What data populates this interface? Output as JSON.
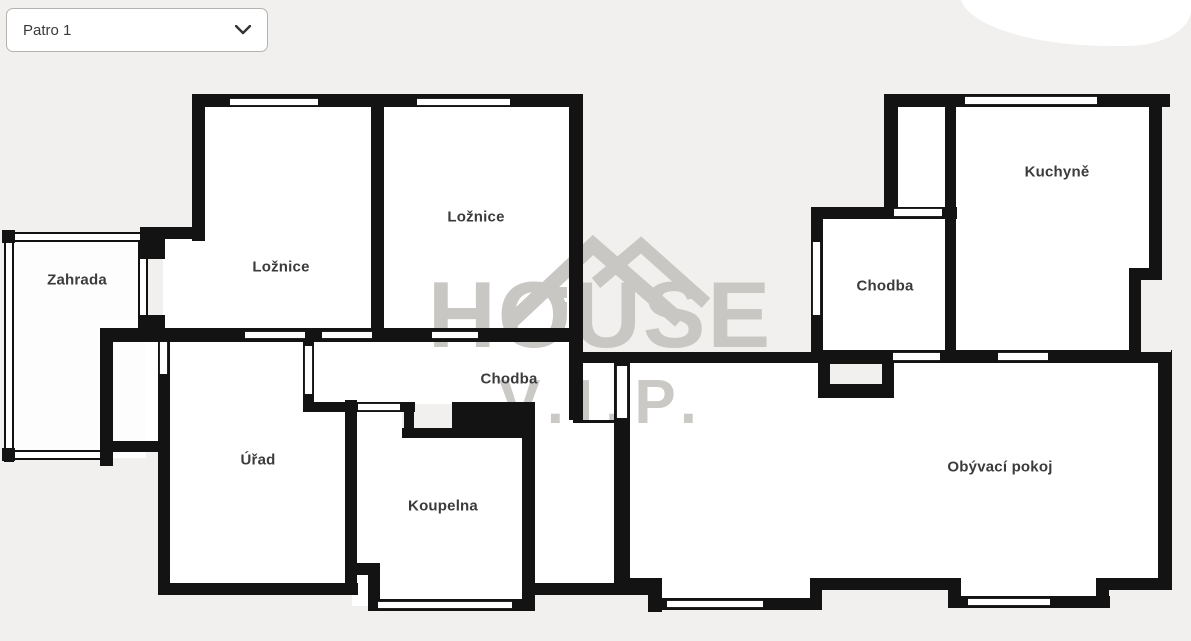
{
  "dropdown": {
    "label": "Patro 1",
    "chevron_icon": "chevron-down-icon"
  },
  "watermark": {
    "brand": "HOUSE",
    "sub": "V.I.P.",
    "color": "#c9c7c4",
    "icon": "house-roof-icon"
  },
  "colors": {
    "background": "#f2f0ee",
    "room_fill": "#ffffff",
    "wall": "#131313",
    "label_text": "#3b3b3b",
    "dropdown_border": "#b5b3b0"
  },
  "rooms": [
    {
      "id": "zahrada",
      "label": "Zahrada",
      "cx": 77,
      "cy": 280
    },
    {
      "id": "loznice-left",
      "label": "Ložnice",
      "cx": 281,
      "cy": 267
    },
    {
      "id": "loznice-top",
      "label": "Ložnice",
      "cx": 476,
      "cy": 217
    },
    {
      "id": "chodba-center",
      "label": "Chodba",
      "cx": 509,
      "cy": 379
    },
    {
      "id": "urad",
      "label": "Úřad",
      "cx": 258,
      "cy": 460
    },
    {
      "id": "koupelna",
      "label": "Koupelna",
      "cx": 443,
      "cy": 506
    },
    {
      "id": "chodba-right",
      "label": "Chodba",
      "cx": 885,
      "cy": 286
    },
    {
      "id": "kuchyne",
      "label": "Kuchyně",
      "cx": 1057,
      "cy": 172
    },
    {
      "id": "obyvaci-pokoj",
      "label": "Obývací pokoj",
      "cx": 1000,
      "cy": 467
    }
  ],
  "plan": {
    "floors": [
      {
        "name": "bedroom-left-floor",
        "x": 202,
        "y": 106,
        "w": 176,
        "h": 228
      },
      {
        "name": "bedroom-left-floor-ext",
        "x": 163,
        "y": 239,
        "w": 67,
        "h": 95
      },
      {
        "name": "bedroom-top-floor",
        "x": 380,
        "y": 106,
        "w": 196,
        "h": 230
      },
      {
        "name": "corridor-center-floor",
        "x": 308,
        "y": 340,
        "w": 266,
        "h": 64
      },
      {
        "name": "corridor-lower-floor",
        "x": 357,
        "y": 404,
        "w": 45,
        "h": 34
      },
      {
        "name": "passage-floor",
        "x": 535,
        "y": 360,
        "w": 84,
        "h": 226
      },
      {
        "name": "office-floor",
        "x": 166,
        "y": 336,
        "w": 186,
        "h": 252
      },
      {
        "name": "utility-floor",
        "x": 108,
        "y": 336,
        "w": 56,
        "h": 108
      },
      {
        "name": "bathroom-floor",
        "x": 352,
        "y": 434,
        "w": 176,
        "h": 172
      },
      {
        "name": "living-room-floor",
        "x": 624,
        "y": 357,
        "w": 546,
        "h": 221
      },
      {
        "name": "living-room-floor-tab1",
        "x": 655,
        "y": 578,
        "w": 165,
        "h": 26
      },
      {
        "name": "living-room-floor-tab2",
        "x": 952,
        "y": 578,
        "w": 156,
        "h": 22
      },
      {
        "name": "hall-right-floor",
        "x": 821,
        "y": 217,
        "w": 126,
        "h": 133
      },
      {
        "name": "strip-room-floor",
        "x": 896,
        "y": 106,
        "w": 51,
        "h": 105
      },
      {
        "name": "kitchen-floor",
        "x": 947,
        "y": 106,
        "w": 202,
        "h": 250
      },
      {
        "name": "garden-floor",
        "x": 8,
        "y": 236,
        "w": 138,
        "h": 222,
        "garden": true
      }
    ],
    "walls": [
      {
        "name": "bedrooms-top-wall",
        "x": 192,
        "y": 94,
        "w": 390,
        "h": 13
      },
      {
        "name": "bedroom-left-wall",
        "x": 192,
        "y": 94,
        "w": 13,
        "h": 147
      },
      {
        "name": "bedroom-step-wall",
        "x": 140,
        "y": 227,
        "w": 64,
        "h": 12
      },
      {
        "name": "bedroom-step-stub",
        "x": 140,
        "y": 227,
        "w": 25,
        "h": 32
      },
      {
        "name": "garden-corner-block",
        "x": 140,
        "y": 315,
        "w": 25,
        "h": 20
      },
      {
        "name": "bedrooms-divider-wall",
        "x": 371,
        "y": 100,
        "w": 13,
        "h": 240
      },
      {
        "name": "bedroom-top-right-wall",
        "x": 569,
        "y": 94,
        "w": 14,
        "h": 326
      },
      {
        "name": "bedrooms-bottom-wall",
        "x": 100,
        "y": 328,
        "w": 483,
        "h": 14
      },
      {
        "name": "building-left-wall",
        "x": 100,
        "y": 328,
        "w": 13,
        "h": 138
      },
      {
        "name": "office-left-wall",
        "x": 158,
        "y": 340,
        "w": 12,
        "h": 255
      },
      {
        "name": "utility-bottom-wall",
        "x": 100,
        "y": 441,
        "w": 70,
        "h": 11
      },
      {
        "name": "office-bottom-wall",
        "x": 158,
        "y": 583,
        "w": 200,
        "h": 12
      },
      {
        "name": "office-right-wall",
        "x": 345,
        "y": 400,
        "w": 12,
        "h": 195
      },
      {
        "name": "office-corridor-stub",
        "x": 303,
        "y": 340,
        "w": 11,
        "h": 72
      },
      {
        "name": "corridor-bottom-wall",
        "x": 303,
        "y": 402,
        "w": 112,
        "h": 10
      },
      {
        "name": "corridor-step-block",
        "x": 452,
        "y": 402,
        "w": 83,
        "h": 36
      },
      {
        "name": "corridor-notch-bottom",
        "x": 402,
        "y": 428,
        "w": 52,
        "h": 10
      },
      {
        "name": "corridor-notch-stub",
        "x": 404,
        "y": 402,
        "w": 10,
        "h": 36
      },
      {
        "name": "bathroom-step-h",
        "x": 345,
        "y": 563,
        "w": 35,
        "h": 12
      },
      {
        "name": "bathroom-step-v",
        "x": 368,
        "y": 563,
        "w": 12,
        "h": 48
      },
      {
        "name": "bathroom-bottom-wall",
        "x": 368,
        "y": 599,
        "w": 167,
        "h": 12
      },
      {
        "name": "bathroom-right-wall",
        "x": 522,
        "y": 420,
        "w": 13,
        "h": 191
      },
      {
        "name": "passage-bottom-wall",
        "x": 522,
        "y": 583,
        "w": 140,
        "h": 12
      },
      {
        "name": "living-left-wall",
        "x": 614,
        "y": 352,
        "w": 16,
        "h": 240
      },
      {
        "name": "passage-threshold",
        "x": 573,
        "y": 420,
        "w": 43,
        "h": 3
      },
      {
        "name": "corridor-ext-top-wall",
        "x": 569,
        "y": 352,
        "w": 246,
        "h": 11
      },
      {
        "name": "living-top-wall",
        "x": 815,
        "y": 350,
        "w": 355,
        "h": 13
      },
      {
        "name": "shaft-notch-wall",
        "x": 818,
        "y": 352,
        "w": 76,
        "h": 46
      },
      {
        "name": "hall-right-left-wall",
        "x": 811,
        "y": 207,
        "w": 12,
        "h": 151
      },
      {
        "name": "hall-right-top-wall",
        "x": 811,
        "y": 207,
        "w": 146,
        "h": 12
      },
      {
        "name": "kitchen-left-wall",
        "x": 884,
        "y": 94,
        "w": 14,
        "h": 119
      },
      {
        "name": "right-top-wall",
        "x": 884,
        "y": 94,
        "w": 286,
        "h": 13
      },
      {
        "name": "kitchen-divider-wall",
        "x": 945,
        "y": 100,
        "w": 11,
        "h": 256
      },
      {
        "name": "kitchen-right-wall-up",
        "x": 1149,
        "y": 94,
        "w": 13,
        "h": 186
      },
      {
        "name": "kitchen-step-wall",
        "x": 1129,
        "y": 268,
        "w": 33,
        "h": 12
      },
      {
        "name": "kitchen-right-wall-low",
        "x": 1129,
        "y": 268,
        "w": 12,
        "h": 92
      },
      {
        "name": "living-right-wall",
        "x": 1158,
        "y": 350,
        "w": 14,
        "h": 240
      },
      {
        "name": "living-bottom-up1",
        "x": 624,
        "y": 578,
        "w": 34,
        "h": 12
      },
      {
        "name": "living-bottom-step1",
        "x": 648,
        "y": 578,
        "w": 14,
        "h": 34
      },
      {
        "name": "living-bottom-low1",
        "x": 655,
        "y": 598,
        "w": 165,
        "h": 12
      },
      {
        "name": "living-bottom-step2",
        "x": 810,
        "y": 578,
        "w": 12,
        "h": 32
      },
      {
        "name": "living-bottom-up2",
        "x": 818,
        "y": 578,
        "w": 136,
        "h": 12
      },
      {
        "name": "living-bottom-step3",
        "x": 948,
        "y": 578,
        "w": 13,
        "h": 30
      },
      {
        "name": "living-bottom-low2",
        "x": 955,
        "y": 596,
        "w": 155,
        "h": 12
      },
      {
        "name": "living-bottom-step4",
        "x": 1096,
        "y": 578,
        "w": 13,
        "h": 30
      },
      {
        "name": "living-bottom-up3",
        "x": 1104,
        "y": 578,
        "w": 68,
        "h": 12
      },
      {
        "name": "garden-corner-tick-tl",
        "x": 2,
        "y": 230,
        "w": 13,
        "h": 13
      },
      {
        "name": "garden-corner-tick-bl",
        "x": 2,
        "y": 448,
        "w": 13,
        "h": 13
      }
    ],
    "thin_walls": [
      {
        "name": "garden-left-wall",
        "x": 4,
        "y": 232,
        "w": 10,
        "h": 230
      },
      {
        "name": "garden-top-wall",
        "x": 4,
        "y": 232,
        "w": 144,
        "h": 10
      },
      {
        "name": "garden-right-wall",
        "x": 138,
        "y": 241,
        "w": 10,
        "h": 95
      },
      {
        "name": "garden-bottom-wall",
        "x": 4,
        "y": 450,
        "w": 108,
        "h": 10
      }
    ],
    "openings": [
      {
        "name": "window-bedroom-left-top",
        "o": "h",
        "x": 230,
        "y": 98,
        "w": 88,
        "h": 8
      },
      {
        "name": "window-bedroom-top-top",
        "o": "h",
        "x": 417,
        "y": 98,
        "w": 93,
        "h": 8
      },
      {
        "name": "door-office-bedroom",
        "o": "h",
        "x": 245,
        "y": 331,
        "w": 60,
        "h": 8
      },
      {
        "name": "door-corridor-bedroom",
        "o": "h",
        "x": 322,
        "y": 331,
        "w": 50,
        "h": 8
      },
      {
        "name": "window-corridor-top",
        "o": "h",
        "x": 432,
        "y": 331,
        "w": 46,
        "h": 8
      },
      {
        "name": "door-corridor-bathroom",
        "o": "h",
        "x": 358,
        "y": 403,
        "w": 42,
        "h": 8
      },
      {
        "name": "door-living-hall",
        "o": "h",
        "x": 893,
        "y": 352,
        "w": 47,
        "h": 9
      },
      {
        "name": "window-living-top",
        "o": "h",
        "x": 998,
        "y": 352,
        "w": 50,
        "h": 9
      },
      {
        "name": "door-hall-strip-room",
        "o": "h",
        "x": 894,
        "y": 208,
        "w": 48,
        "h": 9
      },
      {
        "name": "window-kitchen-top",
        "o": "h",
        "x": 965,
        "y": 96,
        "w": 132,
        "h": 9
      },
      {
        "name": "window-bathroom-bottom",
        "o": "h",
        "x": 378,
        "y": 601,
        "w": 134,
        "h": 8
      },
      {
        "name": "window-living-bottom-left",
        "o": "h",
        "x": 667,
        "y": 600,
        "w": 96,
        "h": 8
      },
      {
        "name": "window-living-bottom-right",
        "o": "h",
        "x": 968,
        "y": 598,
        "w": 82,
        "h": 8
      },
      {
        "name": "window-office-left",
        "o": "v",
        "x": 159,
        "y": 342,
        "w": 9,
        "h": 32
      },
      {
        "name": "window-office-corridor",
        "o": "v",
        "x": 304,
        "y": 346,
        "w": 9,
        "h": 48
      },
      {
        "name": "door-living-left",
        "o": "v",
        "x": 616,
        "y": 366,
        "w": 12,
        "h": 52
      },
      {
        "name": "window-hall-right-left",
        "o": "v",
        "x": 812,
        "y": 242,
        "w": 9,
        "h": 73
      }
    ],
    "patches": [
      {
        "name": "shaft-notch-inner",
        "x": 830,
        "y": 364,
        "w": 52,
        "h": 20
      },
      {
        "name": "corridor-notch-inner",
        "x": 414,
        "y": 412,
        "w": 38,
        "h": 16
      },
      {
        "name": "kitchen-step-outer",
        "x": 1141,
        "y": 280,
        "w": 30,
        "h": 72
      }
    ]
  }
}
